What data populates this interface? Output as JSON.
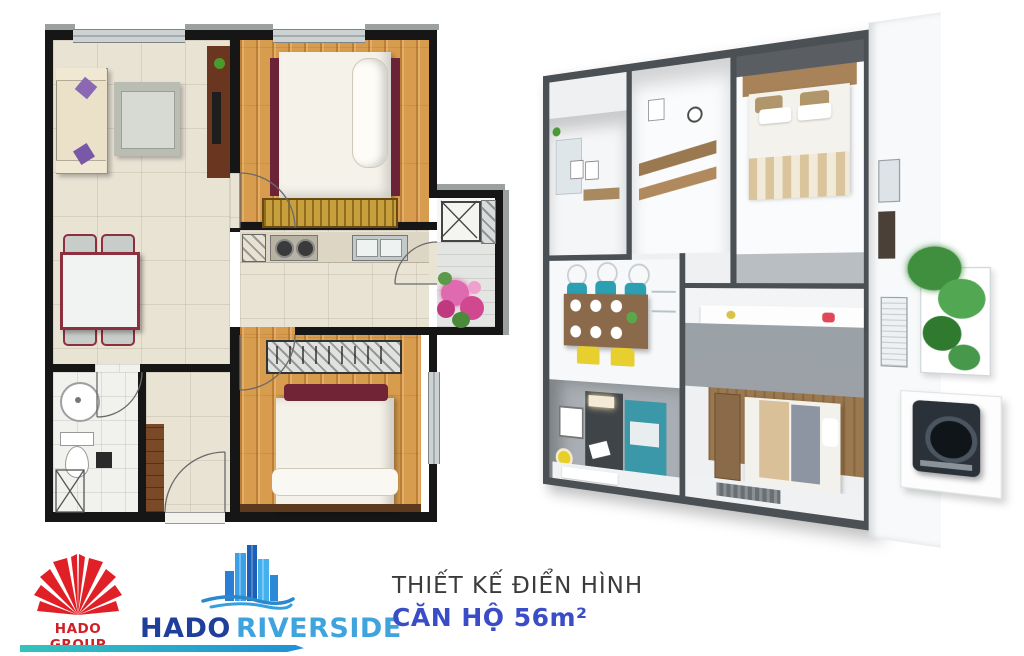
{
  "poster": {
    "background": "#ffffff",
    "footer": {
      "hado_group_label": "HADO GROUP",
      "hado_riverside_word1": "HADO",
      "hado_riverside_word2": "RIVERSIDE",
      "caption_line1": "THIẾT KẾ ĐIỂN HÌNH",
      "caption_line2": "CĂN HỘ 56m²"
    },
    "palette": {
      "wall_black": "#161616",
      "tile_beige": "#e9e3d4",
      "wood_floor": "#d89c4e",
      "bed_rail_maroon": "#6b2437",
      "wardrobe_gold": "#c79f3d",
      "sofa_beige": "#eae1c8",
      "pillow_purple": "#8a68b4",
      "dining_trim_maroon": "#8c3040",
      "iso_wall_charcoal": "#4b5055",
      "iso_teal_accent": "#3a98a8",
      "iso_chair_teal": "#2ba0b2",
      "iso_chair_yellow": "#e6cf2e",
      "logo_red": "#d01f26",
      "logo_blue_dark": "#203f9a",
      "logo_blue_light": "#3fa3de",
      "caption_blue": "#3a4dc7",
      "swoosh_teal": "#35c2bd",
      "swoosh_blue": "#1f90d8"
    },
    "plan_2d_rooms": [
      "living-room",
      "bedroom-1",
      "kitchen",
      "hallway",
      "bedroom-2",
      "bathroom",
      "entry",
      "utility",
      "balcony"
    ],
    "plan_3d_rooms": [
      "bathroom",
      "entry-kitchen",
      "master-bedroom",
      "dining",
      "kitchen-counter",
      "living-room",
      "bedroom-2",
      "loggia"
    ]
  }
}
